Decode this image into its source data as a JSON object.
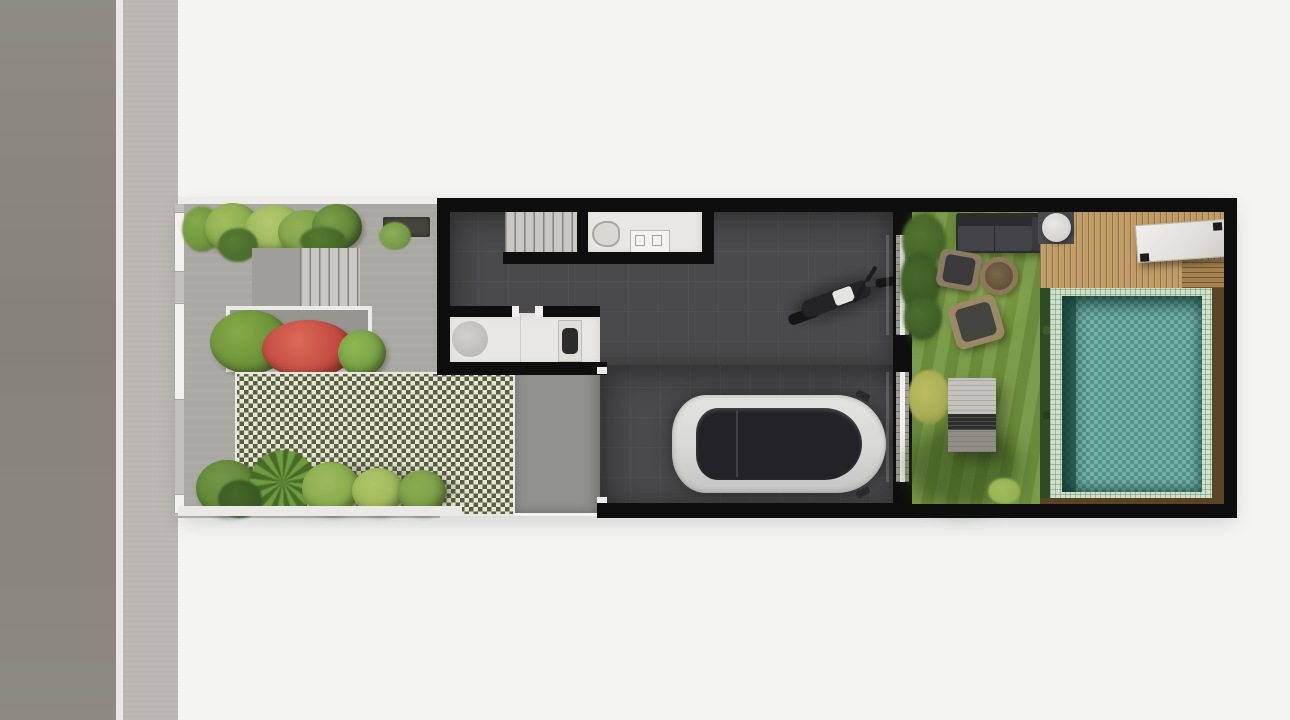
{
  "scene": {
    "description": "Top-down 3D architectural site plan render of a narrow row-house plot between a street and a rear pool garden",
    "orientation": "street on the left, backyard with pool on the right",
    "visible_text": "none"
  },
  "theme": {
    "bg": "#f4f4f2",
    "road": "#8d8983",
    "curb": "#eae8e4",
    "sidewalk": "#b9b6b1",
    "paving": "#aaa8a3",
    "checker_light": "#e6e6dc",
    "checker_dark": "#5a5f3a",
    "apron": "#91918d",
    "wall": "#0e0e0e",
    "floor": "#4a4a4c",
    "white_room": "#e9e7e3",
    "lawn": "#71943d",
    "deck": "#bf9b66",
    "tile": "#cfe0c8",
    "water": "#63a69c",
    "surround": "#5a4426",
    "red_shrub": "#c44c42",
    "car_body": "#d7d7d5",
    "car_glass": "#232327"
  },
  "street": {
    "elements": [
      "asphalt-road",
      "white-curb",
      "concrete-sidewalk"
    ]
  },
  "front_garden": {
    "elements": [
      "boundary-gate-panels",
      "hedge-row",
      "gravel-bed",
      "entry-steps",
      "flower-planter-with-red-shrub",
      "grass-block-checker-paving",
      "concrete-driveway-apron",
      "tropical-plants"
    ]
  },
  "house": {
    "rooms": [
      {
        "name": "staircase"
      },
      {
        "name": "bathroom",
        "fixtures": [
          "toilet",
          "vanity-with-basins"
        ]
      },
      {
        "name": "kitchen",
        "fixtures": [
          "round-sink",
          "cooktop"
        ]
      },
      {
        "name": "garage-hall",
        "vehicles": [
          "motorcycle",
          "car"
        ]
      }
    ],
    "openings": [
      "kitchen-doorway",
      "garage-door",
      "two-sliding-doors-to-backyard"
    ]
  },
  "backyard": {
    "lawn_items": [
      "outdoor-sofa",
      "armchair",
      "fire-pit",
      "armchair",
      "garden-bench",
      "yellow-bush",
      "tall-tree"
    ],
    "deck_items": [
      "round-side-stool",
      "marble-dining-table",
      "deck-step"
    ],
    "pool": {
      "parts": [
        "light-tile-coping",
        "teal-water",
        "dark-plant-strip",
        "brown-wood-surround"
      ]
    }
  }
}
